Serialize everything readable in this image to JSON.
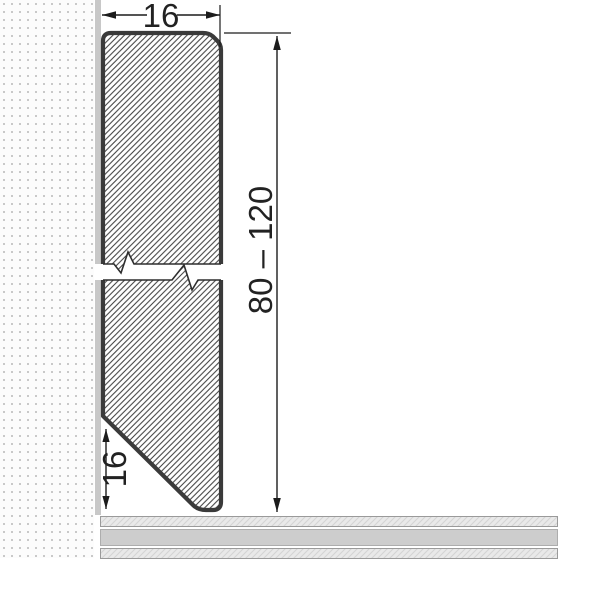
{
  "diagram": {
    "type": "technical-cross-section",
    "subject": "skirting-board-profile-on-wall-with-floor",
    "dimensions": {
      "top_width_label": "16",
      "height_range_label": "80 – 120",
      "bottom_chamfer_label": "16"
    },
    "colors": {
      "profile_outline": "#3a3a3a",
      "profile_hatch_line": "#3d3d3d",
      "dimension_line": "#1c1c1c",
      "wall_strip": "#c8c8c8",
      "wall_dot": "#c9c9c9",
      "floor_plain_band": "#cdcdcd",
      "floor_hatch_band": "#e9e9e9",
      "floor_border": "#9a9a9a",
      "background": "#ffffff"
    }
  }
}
